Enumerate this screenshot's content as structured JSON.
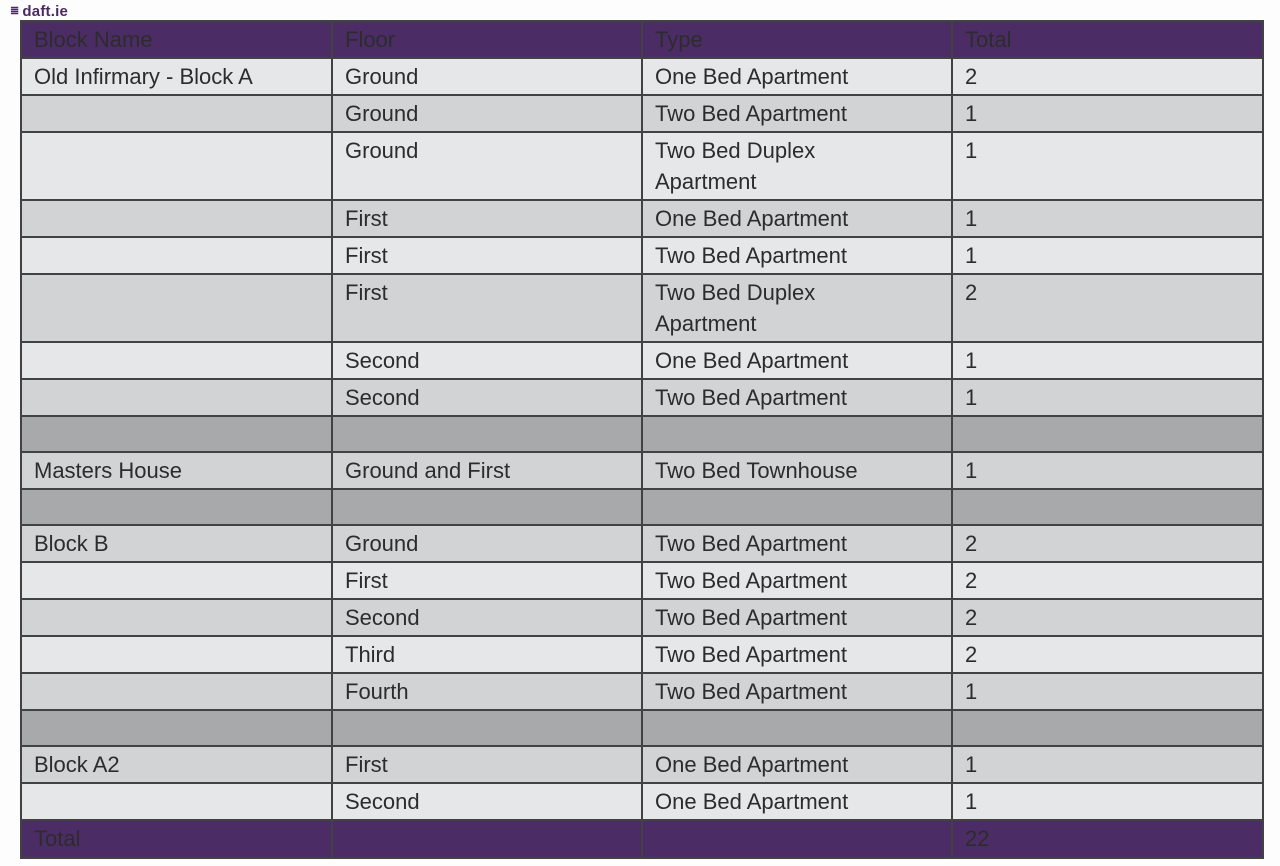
{
  "watermark": {
    "text": "daft.ie"
  },
  "colors": {
    "purple": "#4c2c64",
    "row_light": "#e6e7e9",
    "row_dark": "#d2d3d5",
    "row_spacer": "#a8a9ab",
    "border": "#424244",
    "body_text": "#2c2c2e",
    "header_text": "#f6f2f9"
  },
  "table": {
    "columns": [
      "Block Name",
      "Floor",
      "Type",
      "Total"
    ],
    "rows": [
      {
        "block": "Old Infirmary - Block A",
        "floor": "Ground",
        "type": "One Bed Apartment",
        "total": "2",
        "shade": "light",
        "tall": false
      },
      {
        "block": "",
        "floor": "Ground",
        "type": "Two Bed Apartment",
        "total": "1",
        "shade": "dark",
        "tall": false
      },
      {
        "block": "",
        "floor": "Ground",
        "type": "Two Bed Duplex\nApartment",
        "total": "1",
        "shade": "light",
        "tall": true
      },
      {
        "block": "",
        "floor": "First",
        "type": "One Bed Apartment",
        "total": "1",
        "shade": "dark",
        "tall": false
      },
      {
        "block": "",
        "floor": "First",
        "type": "Two Bed Apartment",
        "total": "1",
        "shade": "light",
        "tall": false
      },
      {
        "block": "",
        "floor": "First",
        "type": "Two Bed Duplex\nApartment",
        "total": "2",
        "shade": "dark",
        "tall": true
      },
      {
        "block": "",
        "floor": "Second",
        "type": "One Bed Apartment",
        "total": "1",
        "shade": "light",
        "tall": false
      },
      {
        "block": "",
        "floor": "Second",
        "type": "Two Bed Apartment",
        "total": "1",
        "shade": "dark",
        "tall": false
      },
      {
        "block": "",
        "floor": "",
        "type": "",
        "total": "",
        "shade": "spacer",
        "tall": false
      },
      {
        "block": "Masters House",
        "floor": "Ground and First",
        "type": "Two Bed Townhouse",
        "total": "1",
        "shade": "dark",
        "tall": false
      },
      {
        "block": "",
        "floor": "",
        "type": "",
        "total": "",
        "shade": "spacer",
        "tall": false
      },
      {
        "block": "Block B",
        "floor": "Ground",
        "type": "Two Bed Apartment",
        "total": "2",
        "shade": "dark",
        "tall": false
      },
      {
        "block": "",
        "floor": "First",
        "type": "Two Bed Apartment",
        "total": "2",
        "shade": "light",
        "tall": false
      },
      {
        "block": "",
        "floor": "Second",
        "type": "Two Bed Apartment",
        "total": "2",
        "shade": "dark",
        "tall": false
      },
      {
        "block": "",
        "floor": "Third",
        "type": "Two Bed Apartment",
        "total": "2",
        "shade": "light",
        "tall": false
      },
      {
        "block": "",
        "floor": "Fourth",
        "type": "Two Bed Apartment",
        "total": "1",
        "shade": "dark",
        "tall": false
      },
      {
        "block": "",
        "floor": "",
        "type": "",
        "total": "",
        "shade": "spacer",
        "tall": false
      },
      {
        "block": "Block A2",
        "floor": "First",
        "type": "One Bed Apartment",
        "total": "1",
        "shade": "dark",
        "tall": false
      },
      {
        "block": "",
        "floor": "Second",
        "type": "One Bed Apartment",
        "total": "1",
        "shade": "light",
        "tall": false
      }
    ],
    "footer": {
      "label": "Total",
      "grand_total": "22"
    }
  }
}
